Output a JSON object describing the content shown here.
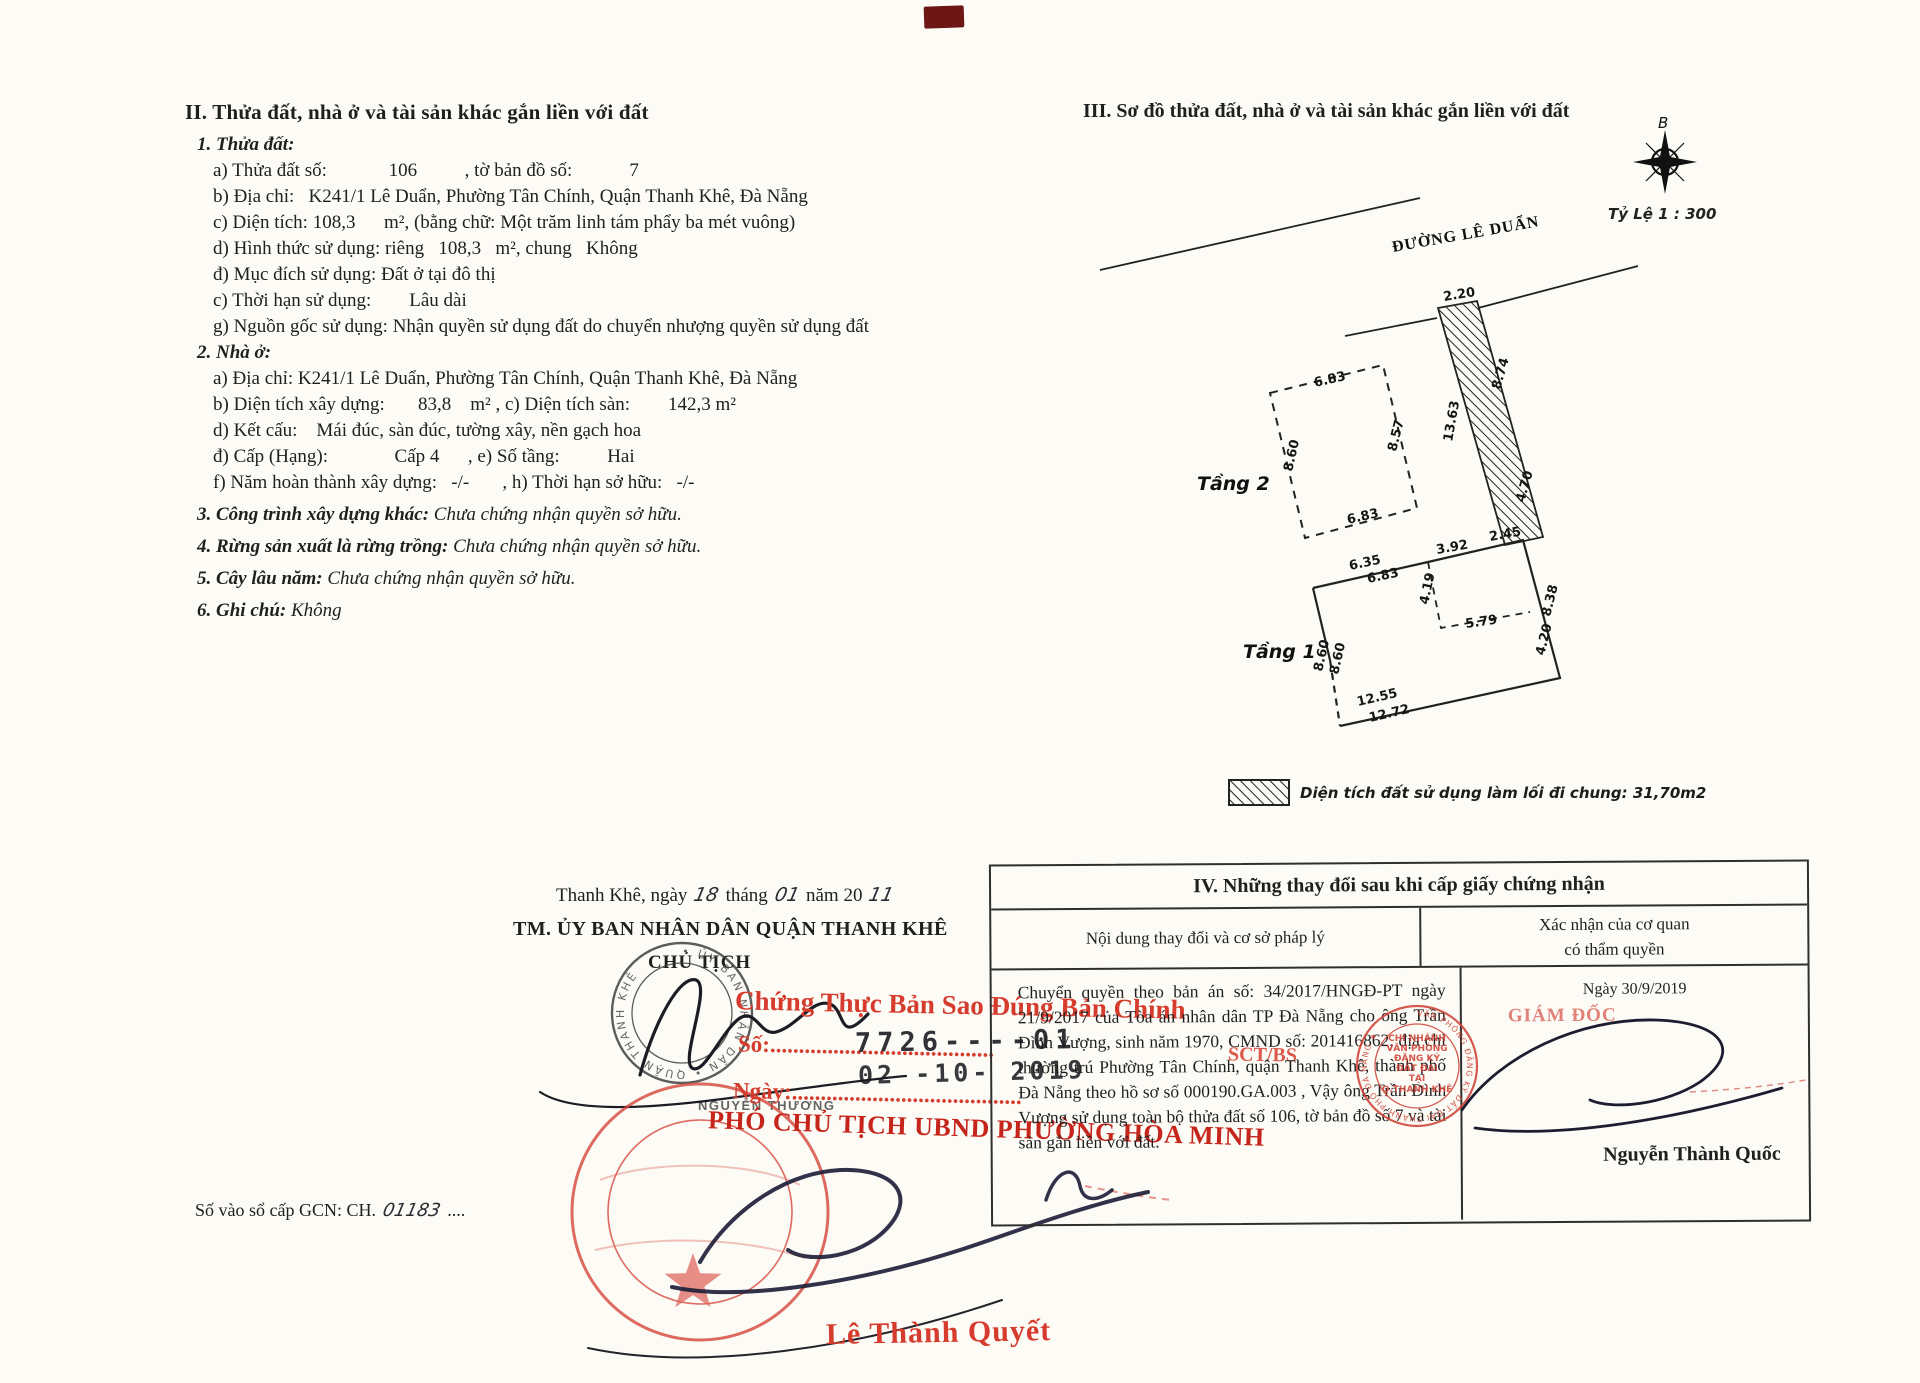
{
  "section2": {
    "title": "II. Thửa đất, nhà ở và tài sản khác gắn liền với đất",
    "lines": [
      {
        "head": "1. Thửa đất:"
      },
      {
        "text": "a) Thửa đất số:             106          , tờ bản đồ số:            7"
      },
      {
        "text": "b) Địa chỉ:   K241/1 Lê Duẩn, Phường Tân Chính, Quận Thanh Khê, Đà Nẵng"
      },
      {
        "text": "c) Diện tích: 108,3      m², (bằng chữ: Một trăm linh tám phẩy ba mét vuông)"
      },
      {
        "text": "d) Hình thức sử dụng: riêng   108,3   m², chung   Không"
      },
      {
        "text": "đ) Mục đích sử dụng: Đất ở tại đô thị"
      },
      {
        "text": "c) Thời hạn sử dụng:        Lâu dài"
      },
      {
        "text": "g) Nguồn gốc sử dụng: Nhận quyền sử dụng đất do chuyển nhượng quyền sử dụng đất"
      },
      {
        "head": "2. Nhà ở:"
      },
      {
        "text": "a) Địa chỉ: K241/1 Lê Duẩn, Phường Tân Chính, Quận Thanh Khê, Đà Nẵng"
      },
      {
        "text": "b) Diện tích xây dựng:       83,8    m² , c) Diện tích sàn:        142,3 m²"
      },
      {
        "text": "d) Kết cấu:    Mái đúc, sàn đúc, tường xây, nền gạch hoa"
      },
      {
        "text": "đ) Cấp (Hạng):              Cấp 4      , e) Số tầng:          Hai"
      },
      {
        "text": "f) Năm hoàn thành xây dựng:   -/-       , h) Thời hạn sở hữu:   -/-"
      },
      {
        "head": "3. Công trình xây dựng khác:",
        "tail": " Chưa chứng nhận quyền sở hữu."
      },
      {
        "head": "4. Rừng sản xuất là rừng trồng:",
        "tail": " Chưa chứng nhận quyền sở hữu."
      },
      {
        "head": "5. Cây lâu năm:",
        "tail": " Chưa chứng nhận quyền sở hữu."
      },
      {
        "head": "6. Ghi chú:",
        "tail": " Không"
      }
    ]
  },
  "section3": {
    "title": "III. Sơ đồ thửa đất, nhà ở và tài sản khác gắn liền với đất",
    "compass_label": "B",
    "scale_label": "Tỷ Lệ 1 : 300",
    "road_label": "ĐƯỜNG LÊ DUẨN",
    "floor2_label": "Tầng 2",
    "floor1_label": "Tầng 1",
    "dims": {
      "strip_top": "2.20",
      "strip_right_upper": "8.74",
      "strip_left": "13.63",
      "strip_right_lower": "4.70",
      "strip_bottom": "2.45",
      "f2_top": "6.83",
      "f2_right": "8.57",
      "f2_left": "8.60",
      "f2_bottom": "6.83",
      "f1_top_outer": "6.35",
      "f1_top_inner": "6.83",
      "f1_topright": "3.92",
      "f1_inner_v": "4.19",
      "f1_inner_h": "5.79",
      "f1_right_upper": "8.38",
      "f1_right_lower": "4.20",
      "f1_left_outer": "8.60",
      "f1_left_inner": "8.60",
      "f1_bottom_outer": "12.55",
      "f1_bottom_inner": "12.72"
    },
    "legend_label": "Diện tích đất sử dụng làm lối đi chung: 31,70m2"
  },
  "signing": {
    "date_prefix": "Thanh Khê, ngày",
    "date_day": "18",
    "date_month_label": "tháng",
    "date_month": "01",
    "date_year_label": "năm 20",
    "date_year": "11",
    "committee": "TM. ỦY BAN NHÂN DÂN QUẬN THANH KHÊ",
    "chairman_title": "CHỦ TỊCH",
    "seal_ring_text": "• ỦY BAN NHÂN DÂN • QUẬN THANH KHÊ",
    "signer_name": "NGUYỄN THƯƠNG"
  },
  "overprint": {
    "line1": "Chứng Thực Bản Sao Đúng Bản Chính",
    "so_label": "Số:.......................................",
    "stamp_number": "7726----01",
    "stamp_date": "02 -10- 2019",
    "fragment": "SCT/BS",
    "ngay_label": "Ngày:........................................",
    "vice_chairman": "PHÓ CHỦ TỊCH UBND PHƯỜNG HÒA MINH",
    "signer_name": "Lê Thành Quyết"
  },
  "gcn": {
    "label": "Số vào sổ cấp GCN: CH.",
    "number": "01183",
    "dots": "...."
  },
  "table4": {
    "title": "IV. Những thay đổi sau khi cấp giấy chứng nhận",
    "col1": "Nội dung thay đổi và cơ sở pháp lý",
    "col2a": "Xác nhận của cơ quan",
    "col2b": "có thẩm quyền",
    "content": "Chuyển quyền theo bản án số: 34/2017/HNGĐ-PT ngày 21/9/2017 của Tòa án nhân dân TP Đà Nẵng cho ông Trần Đình Vượng, sinh năm 1970, CMND số: 201416862, địa chỉ thường trú Phường Tân Chính, quận Thanh Khê, thành phố Đà Nẵng theo hồ sơ số 000190.GA.003 , Vậy ông Trần Đình Vượng sử dụng toàn bộ thửa đất số 106, tờ bản đồ số 7 và tài sản gắn liền với đất.",
    "confirm_date": "Ngày 30/9/2019",
    "director_title": "GIÁM ĐỐC",
    "seal_center_lines": [
      "CHI NHÁNH",
      "VĂN PHÒNG",
      "ĐĂNG KÝ",
      "ĐẤT ĐAI",
      "TẠI",
      "Q.THANH KHÊ"
    ],
    "seal_ring_text": "VĂN PHÒNG ĐĂNG KÝ ĐẤT ĐAI THÀNH PHỐ ĐÀ NẴNG ★",
    "confirm_name": "Nguyễn Thành Quốc"
  }
}
